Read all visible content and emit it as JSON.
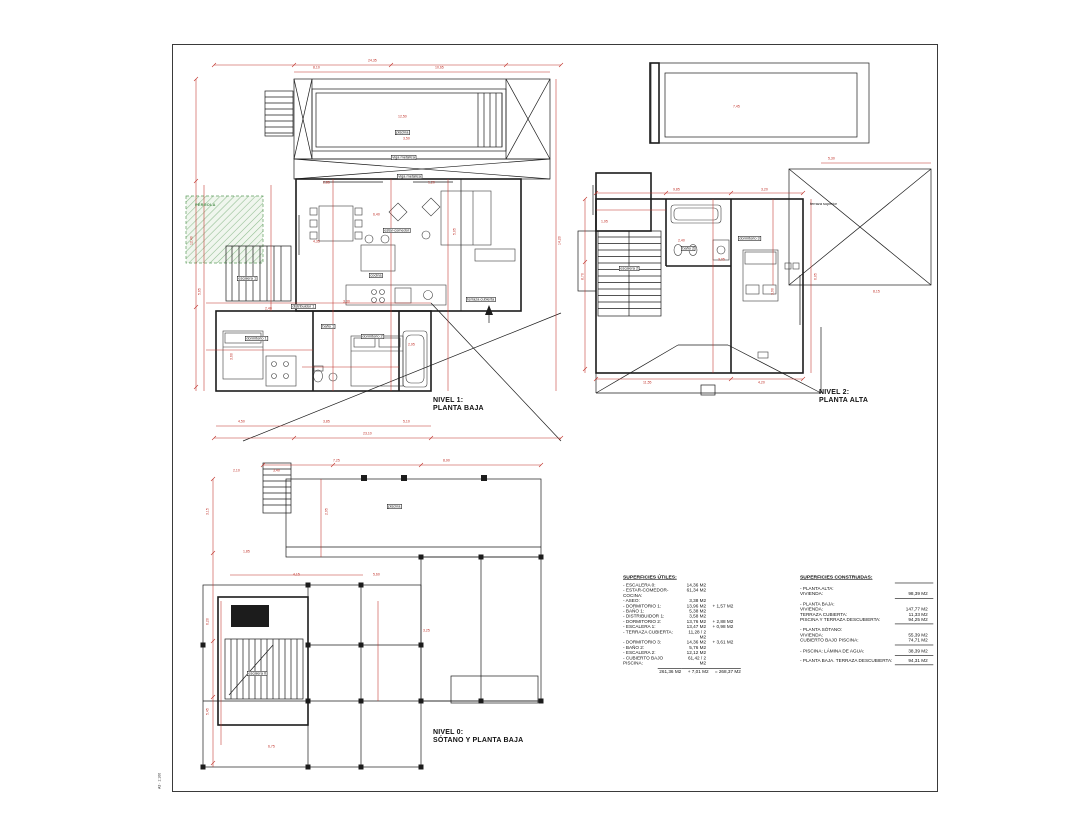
{
  "sheet": {
    "stamp": "A3 · 1:100"
  },
  "colors": {
    "dimension_red": "#c03028",
    "line_black": "#1c1c1c",
    "hatch_green": "#5f9e5f"
  },
  "titles": {
    "plan1": {
      "line1": "NIVEL 1:",
      "line2": "PLANTA BAJA"
    },
    "plan2": {
      "line1": "NIVEL 2:",
      "line2": "PLANTA ALTA"
    },
    "plan3": {
      "line1": "NIVEL 0:",
      "line2": "SÓTANO Y PLANTA BAJA"
    }
  },
  "tables": {
    "utiles": {
      "title": "SUPERFICIES ÚTILES:",
      "rows": [
        {
          "label": "- ESCALERA 0:",
          "value": "14,36 M2",
          "extra": ""
        },
        {
          "label": "- ESTAR-COMEDOR-COCINA:",
          "value": "61,34 M2",
          "extra": ""
        },
        {
          "label": "- ASEO:",
          "value": "3,38 M2",
          "extra": ""
        },
        {
          "label": "- DORMITORIO 1:",
          "value": "13,96 M2",
          "extra": "+ 1,57 M2"
        },
        {
          "label": "- BAÑO 1:",
          "value": "5,38 M2",
          "extra": ""
        },
        {
          "label": "- DISTRIBUIDOR 1:",
          "value": "3,58 M2",
          "extra": ""
        },
        {
          "label": "- DORMITORIO 2:",
          "value": "13,76 M2",
          "extra": "+ 2,88 M2"
        },
        {
          "label": "- ESCALERA 1:",
          "value": "13,47 M2",
          "extra": "+ 0,98 M2"
        },
        {
          "label": "- TERRAZA CUBIERTA:",
          "value": "11,28 / 2 M2",
          "extra": ""
        },
        {
          "label": "- DORMITORIO 3:",
          "value": "14,36 M2",
          "extra": "+ 3,61 M2"
        },
        {
          "label": "- BAÑO 2:",
          "value": "5,76 M2",
          "extra": ""
        },
        {
          "label": "- ESCALERA 2:",
          "value": "12,12 M2",
          "extra": ""
        },
        {
          "label": "- CUBIERTO BAJO PISCINA:",
          "value": "61,42 / 2 M2",
          "extra": ""
        }
      ],
      "total": {
        "value": "261,36 M2",
        "extra": "+ 7,01 M2",
        "total": "= 268,37 M2"
      }
    },
    "construidas": {
      "title": "SUPERFICIES CONSTRUIDAS:",
      "groups": [
        {
          "header": "- PLANTA ALTA:",
          "rows": [
            {
              "label": "VIVIENDA:",
              "value": "98,39 M2"
            }
          ]
        },
        {
          "header": "- PLANTA BAJA:",
          "rows": [
            {
              "label": "VIVIENDA:",
              "value": "147,77 M2"
            },
            {
              "label": "TERRAZA CUBIERTA:",
              "value": "11,33 M2"
            },
            {
              "label": "PISCINA Y TERRAZA DESCUBIERTA:",
              "value": "94,25 M2"
            }
          ]
        },
        {
          "header": "- PLANTA SÓTANO:",
          "rows": [
            {
              "label": "VIVIENDA:",
              "value": "55,39 M2"
            },
            {
              "label": "CUBIERTO BAJO PISCINA:",
              "value": "74,71 M2"
            }
          ]
        },
        {
          "header": "",
          "rows": [
            {
              "label": "- PISCINA: LÁMINA DE AGUA:",
              "value": "38,39 M2"
            }
          ]
        },
        {
          "header": "",
          "rows": [
            {
              "label": "- PLANTA BAJA. TERRAZA DESCUBIERTA:",
              "value": "94,31 M2"
            }
          ]
        }
      ]
    }
  },
  "annotations": [
    {
      "x": 195,
      "y": 14,
      "t": "24,35",
      "c": "dim"
    },
    {
      "x": 140,
      "y": 21,
      "t": "8,10",
      "c": "dim"
    },
    {
      "x": 262,
      "y": 21,
      "t": "10,65",
      "c": "dim"
    },
    {
      "x": 17,
      "y": 200,
      "t": "12,40",
      "c": "dim",
      "r": -90
    },
    {
      "x": 25,
      "y": 250,
      "t": "5,65",
      "c": "dim",
      "r": -90
    },
    {
      "x": 385,
      "y": 200,
      "t": "14,20",
      "c": "dim",
      "r": -90
    },
    {
      "x": 225,
      "y": 70,
      "t": "12,50",
      "c": "dim"
    },
    {
      "x": 230,
      "y": 92,
      "t": "3,50",
      "c": "dim"
    },
    {
      "x": 150,
      "y": 136,
      "t": "2,85",
      "c": "dim"
    },
    {
      "x": 255,
      "y": 136,
      "t": "1,20",
      "c": "dim"
    },
    {
      "x": 140,
      "y": 195,
      "t": "4,35",
      "c": "dim"
    },
    {
      "x": 200,
      "y": 168,
      "t": "6,40",
      "c": "dim"
    },
    {
      "x": 92,
      "y": 262,
      "t": "2,40",
      "c": "dim"
    },
    {
      "x": 170,
      "y": 255,
      "t": "3,30",
      "c": "dim"
    },
    {
      "x": 235,
      "y": 298,
      "t": "2,95",
      "c": "dim"
    },
    {
      "x": 57,
      "y": 315,
      "t": "3,60",
      "c": "dim",
      "r": -90
    },
    {
      "x": 280,
      "y": 190,
      "t": "5,05",
      "c": "dim",
      "r": -90
    },
    {
      "x": 190,
      "y": 387,
      "t": "23,10",
      "c": "dim"
    },
    {
      "x": 65,
      "y": 375,
      "t": "4,50",
      "c": "dim"
    },
    {
      "x": 150,
      "y": 375,
      "t": "3,85",
      "c": "dim"
    },
    {
      "x": 230,
      "y": 375,
      "t": "5,10",
      "c": "dim"
    },
    {
      "x": 222,
      "y": 85,
      "t": "piscina",
      "c": "roombox"
    },
    {
      "x": 218,
      "y": 110,
      "t": "viga metálica",
      "c": "roombox"
    },
    {
      "x": 224,
      "y": 129,
      "t": "viga metálica",
      "c": "roombox"
    },
    {
      "x": 210,
      "y": 183,
      "t": "estar-comedor",
      "c": "roombox"
    },
    {
      "x": 196,
      "y": 228,
      "t": "cocina",
      "c": "roombox"
    },
    {
      "x": 64,
      "y": 231,
      "t": "escalera 1",
      "c": "roombox"
    },
    {
      "x": 72,
      "y": 291,
      "t": "dormitorio 1",
      "c": "roombox"
    },
    {
      "x": 118,
      "y": 259,
      "t": "distribuidor 1",
      "c": "roombox"
    },
    {
      "x": 148,
      "y": 279,
      "t": "baño 1",
      "c": "roombox"
    },
    {
      "x": 188,
      "y": 289,
      "t": "dormitorio 2",
      "c": "roombox"
    },
    {
      "x": 293,
      "y": 252,
      "t": "terraza cubierta",
      "c": "roombox"
    },
    {
      "x": 22,
      "y": 158,
      "t": "PÉRGOLA",
      "c": "green"
    },
    {
      "x": 500,
      "y": 143,
      "t": "9,85",
      "c": "dim"
    },
    {
      "x": 588,
      "y": 143,
      "t": "3,20",
      "c": "dim"
    },
    {
      "x": 408,
      "y": 235,
      "t": "8,70",
      "c": "dim",
      "r": -90
    },
    {
      "x": 641,
      "y": 235,
      "t": "6,05",
      "c": "dim",
      "r": -90
    },
    {
      "x": 470,
      "y": 336,
      "t": "11,55",
      "c": "dim"
    },
    {
      "x": 585,
      "y": 336,
      "t": "4,20",
      "c": "dim"
    },
    {
      "x": 505,
      "y": 194,
      "t": "2,40",
      "c": "dim"
    },
    {
      "x": 545,
      "y": 213,
      "t": "3,05",
      "c": "dim"
    },
    {
      "x": 598,
      "y": 250,
      "t": "3,90",
      "c": "dim",
      "r": -90
    },
    {
      "x": 655,
      "y": 112,
      "t": "5,30",
      "c": "dim"
    },
    {
      "x": 560,
      "y": 60,
      "t": "7,45",
      "c": "dim"
    },
    {
      "x": 428,
      "y": 175,
      "t": "1,95",
      "c": "dim"
    },
    {
      "x": 700,
      "y": 245,
      "t": "8,15",
      "c": "dim"
    },
    {
      "x": 637,
      "y": 157,
      "t": "terraza superior",
      "c": "room"
    },
    {
      "x": 446,
      "y": 221,
      "t": "escalera 2",
      "c": "roombox"
    },
    {
      "x": 508,
      "y": 201,
      "t": "baño 2",
      "c": "roombox"
    },
    {
      "x": 565,
      "y": 191,
      "t": "dormitorio 3",
      "c": "roombox"
    },
    {
      "x": 33,
      "y": 470,
      "t": "3,15",
      "c": "dim",
      "r": -90
    },
    {
      "x": 33,
      "y": 580,
      "t": "6,20",
      "c": "dim",
      "r": -90
    },
    {
      "x": 33,
      "y": 670,
      "t": "5,45",
      "c": "dim",
      "r": -90
    },
    {
      "x": 60,
      "y": 424,
      "t": "2,10",
      "c": "dim"
    },
    {
      "x": 100,
      "y": 424,
      "t": "3,40",
      "c": "dim"
    },
    {
      "x": 160,
      "y": 414,
      "t": "7,25",
      "c": "dim"
    },
    {
      "x": 270,
      "y": 414,
      "t": "8,90",
      "c": "dim"
    },
    {
      "x": 120,
      "y": 528,
      "t": "4,15",
      "c": "dim"
    },
    {
      "x": 200,
      "y": 528,
      "t": "5,60",
      "c": "dim"
    },
    {
      "x": 70,
      "y": 505,
      "t": "1,85",
      "c": "dim"
    },
    {
      "x": 152,
      "y": 470,
      "t": "2,95",
      "c": "dim",
      "r": -90
    },
    {
      "x": 250,
      "y": 584,
      "t": "3,25",
      "c": "dim"
    },
    {
      "x": 95,
      "y": 700,
      "t": "6,75",
      "c": "dim"
    },
    {
      "x": 214,
      "y": 459,
      "t": "piscina",
      "c": "roombox"
    },
    {
      "x": 74,
      "y": 626,
      "t": "escalera 0",
      "c": "roombox"
    }
  ]
}
